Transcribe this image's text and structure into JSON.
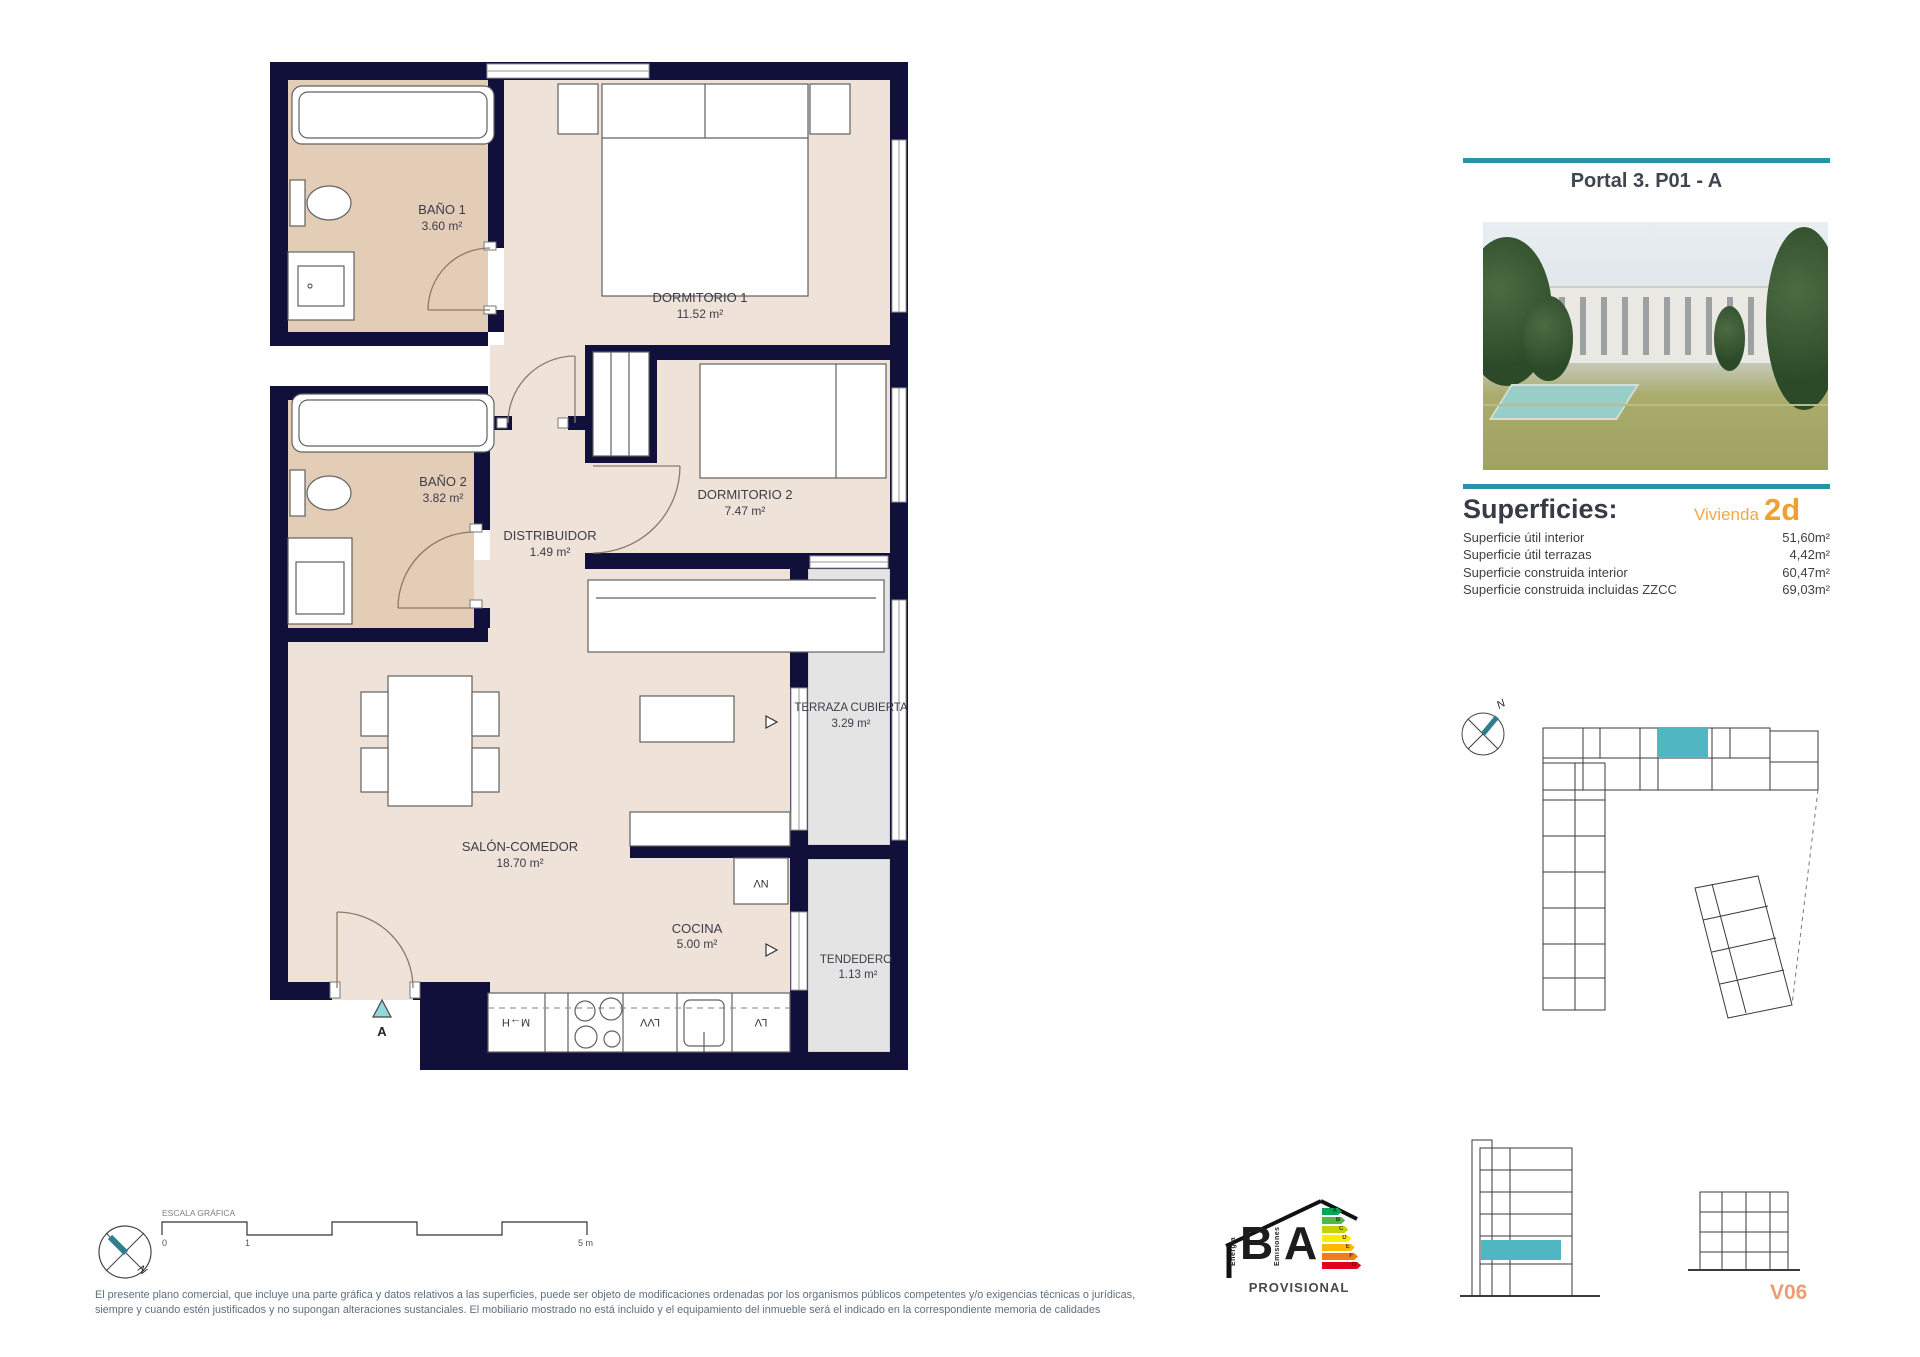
{
  "plan": {
    "rooms": [
      {
        "name": "BAÑO 1",
        "area": "3.60 m²"
      },
      {
        "name": "DORMITORIO 1",
        "area": "11.52 m²"
      },
      {
        "name": "BAÑO 2",
        "area": "3.82 m²"
      },
      {
        "name": "DORMITORIO 2",
        "area": "7.47 m²"
      },
      {
        "name": "DISTRIBUIDOR",
        "area": "1.49 m²"
      },
      {
        "name": "SALÓN-COMEDOR",
        "area": "18.70 m²"
      },
      {
        "name": "COCINA",
        "area": "5.00 m²"
      },
      {
        "name": "TERRAZA CUBIERTA",
        "area": "3.29 m²"
      },
      {
        "name": "TENDEDERO",
        "area": "1.13 m²"
      }
    ],
    "entrance_label": "A",
    "appliances": {
      "fridge": "M→H",
      "dishwasher": "LVV",
      "washer": "LV",
      "vent": "NV"
    }
  },
  "panel": {
    "title": "Portal 3. P01 - A",
    "superficies": {
      "heading": "Superficies:",
      "vivienda_label": "Vivienda",
      "vivienda_code": "2d",
      "rows": [
        {
          "label": "Superficie útil interior",
          "value": "51,60m²"
        },
        {
          "label": "Superficie útil terrazas",
          "value": "4,42m²"
        },
        {
          "label": "Superficie construida interior",
          "value": "60,47m²"
        },
        {
          "label": "Superficie construida incluidas ZZCC",
          "value": "69,03m²"
        }
      ]
    },
    "unit_code": "V06"
  },
  "north_label": "N",
  "scale_bar": {
    "label": "ESCALA GRÁFICA",
    "ticks": [
      "0",
      "1",
      "5 m"
    ]
  },
  "energy": {
    "letter_b": "B",
    "letter_a": "A",
    "word_left": "Energía",
    "word_right": "Emisiones",
    "status": "PROVISIONAL",
    "bars": [
      "A",
      "B",
      "C",
      "D",
      "E",
      "F",
      "G"
    ],
    "colors": [
      "#00a651",
      "#50b848",
      "#c8d200",
      "#ffed00",
      "#fbba00",
      "#f07d1a",
      "#e2001a"
    ]
  },
  "disclaimer": {
    "line1": "El presente plano comercial, que incluye una parte gráfica y datos relativos a las superficies, puede ser objeto de modificaciones ordenadas por los organismos públicos competentes y/o exigencias técnicas o jurídicas,",
    "line2": "siempre y cuando estén justificados y no supongan alteraciones sustanciales. El mobiliario mostrado no está incluido y el equipamiento del inmueble será el indicado en la correspondiente memoria de calidades"
  },
  "colors": {
    "wall": "#10103A",
    "accent_teal": "#2693A6",
    "highlight_unit": "#4FB6C2",
    "orange": "#F0A030"
  }
}
